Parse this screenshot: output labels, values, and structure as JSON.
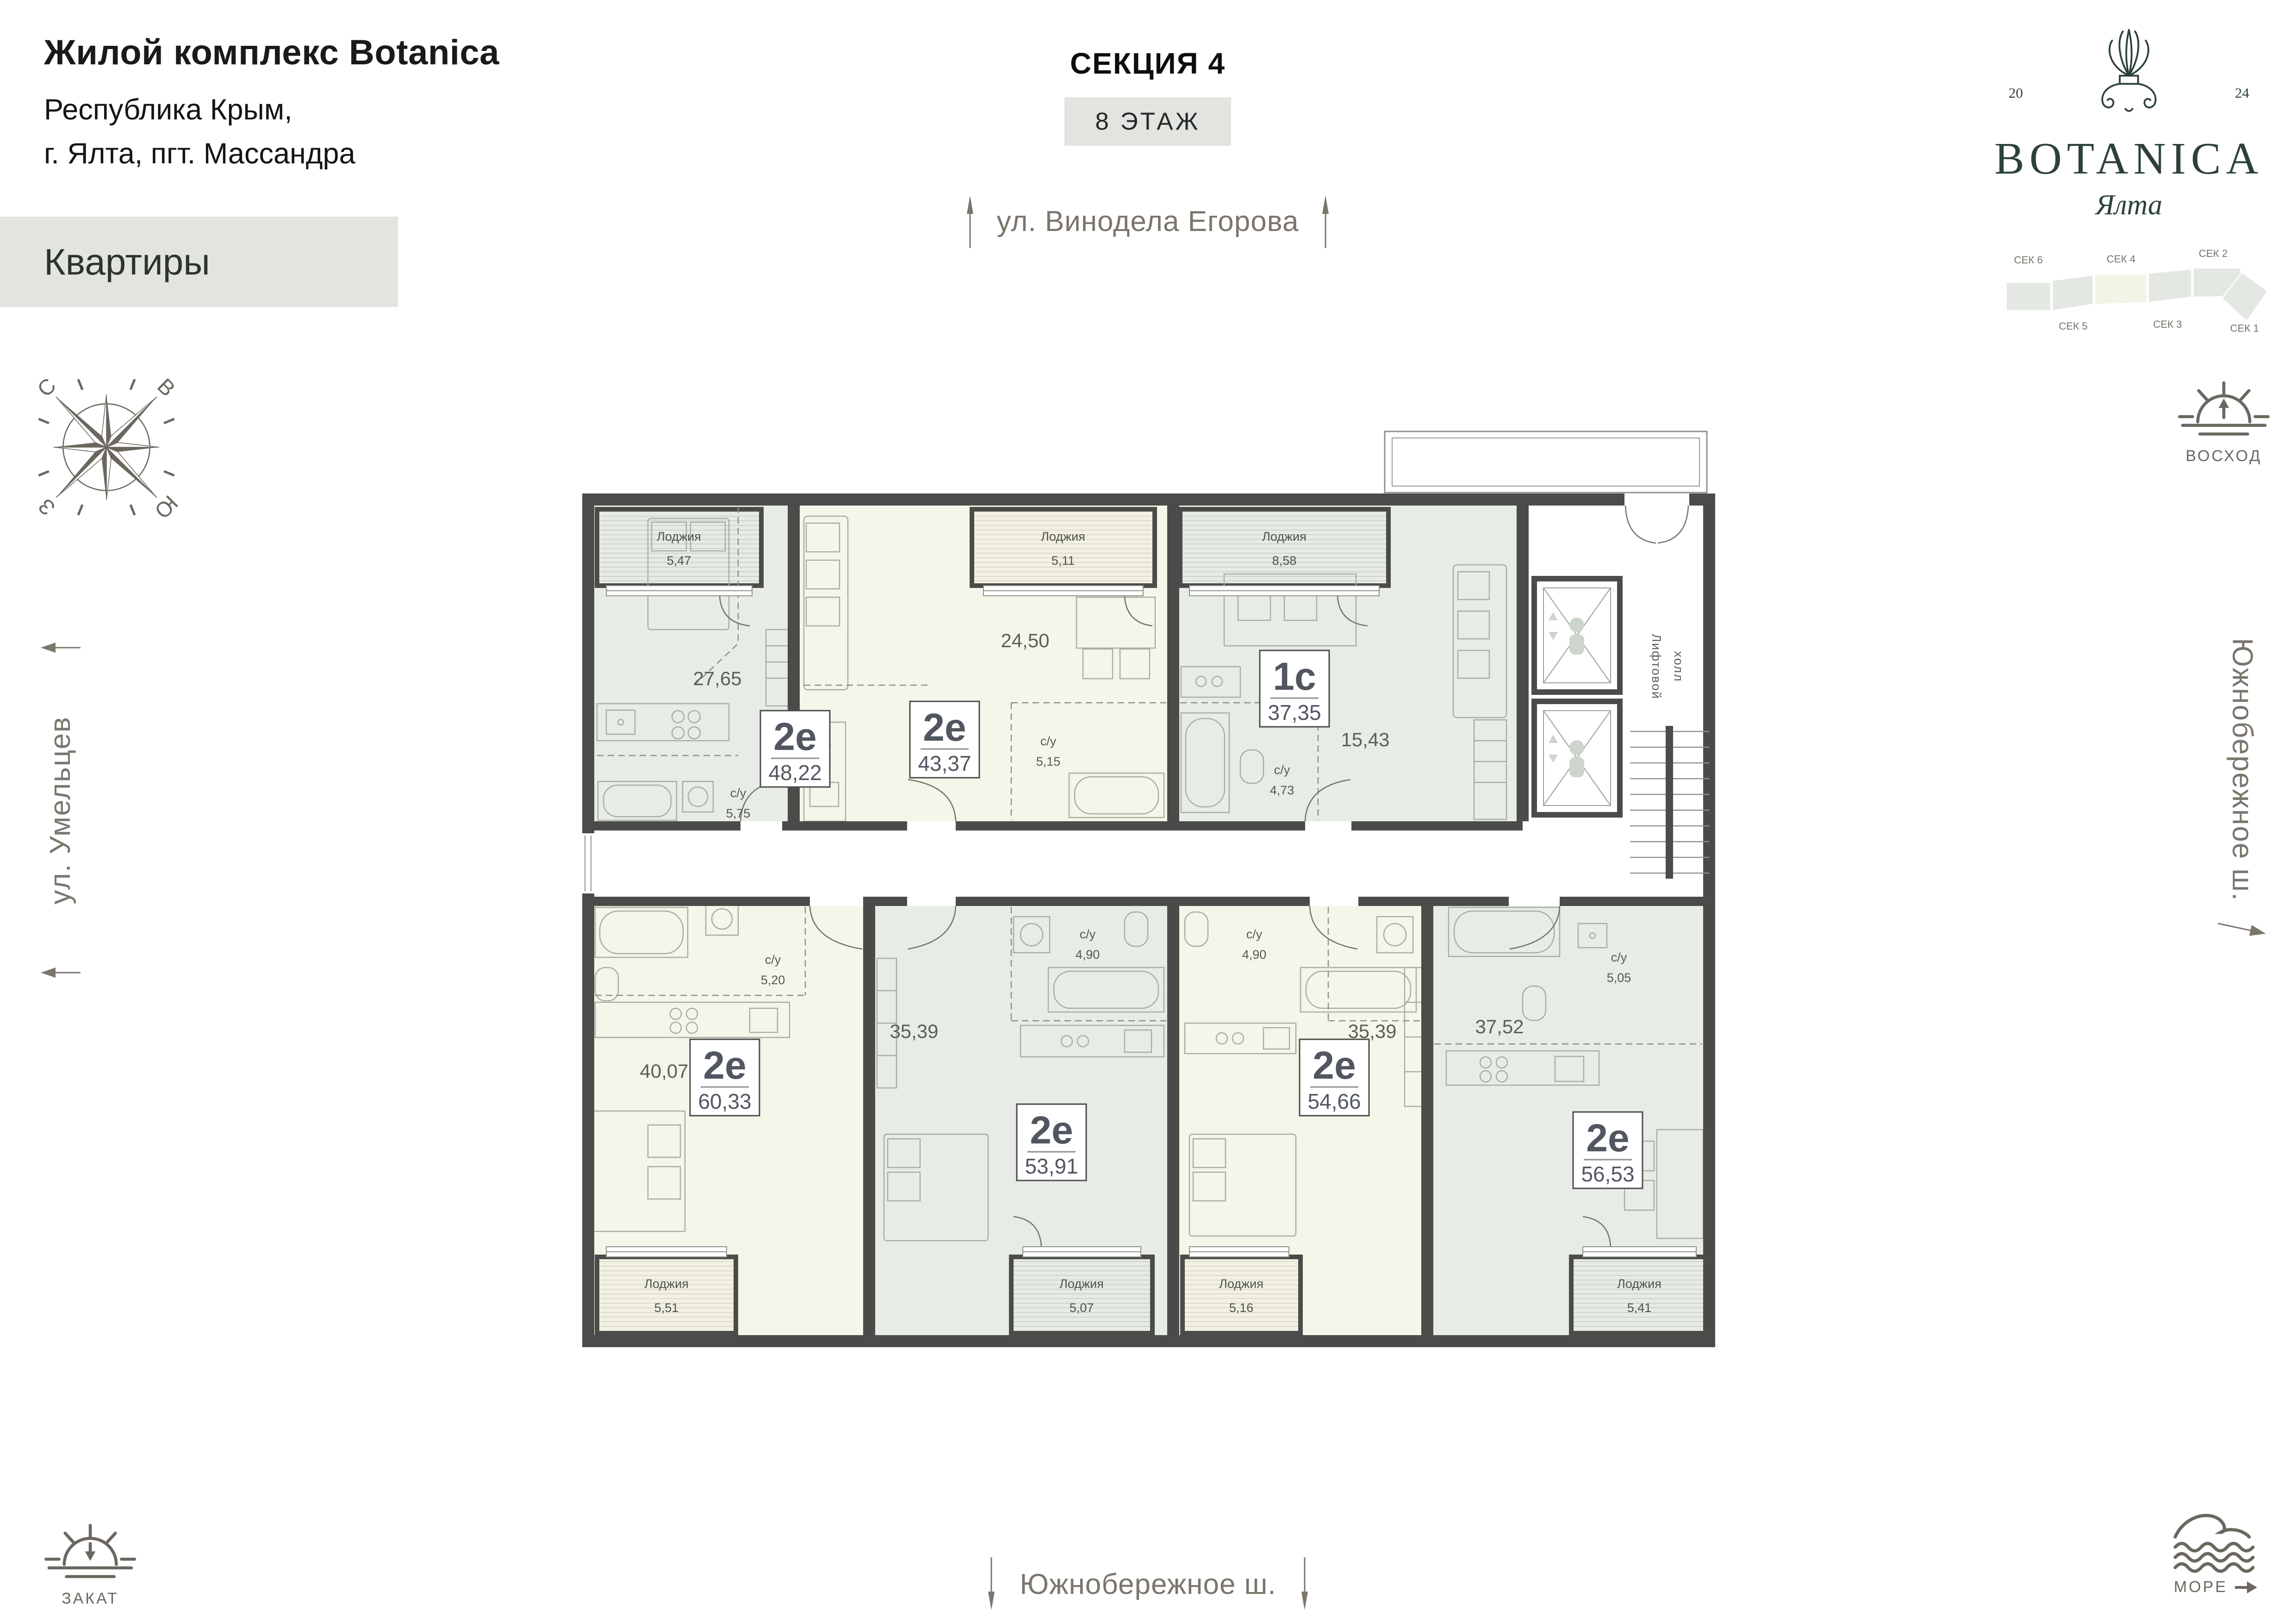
{
  "header": {
    "project_title": "Жилой комплекс Botanica",
    "address_line1": "Республика Крым,",
    "address_line2": "г. Ялта, пгт. Массандра",
    "page_label": "Квартиры",
    "section_title": "СЕКЦИЯ 4",
    "floor_label": "8 ЭТАЖ"
  },
  "logo": {
    "year_left": "20",
    "year_right": "24",
    "brand": "BOTANICA",
    "city": "Ялта"
  },
  "section_map": {
    "labels": [
      "СЕК 6",
      "СЕК 4",
      "СЕК 2",
      "СЕК 5",
      "СЕК 3",
      "СЕК 1"
    ],
    "highlighted": "СЕК 4"
  },
  "compass": {
    "n": "С",
    "e": "В",
    "w": "З",
    "s": "Ю"
  },
  "streets": {
    "top": "ул. Винодела Егорова",
    "left": "ул. Умельцев",
    "right": "Южнобережное ш.",
    "bottom": "Южнобережное ш."
  },
  "legend": {
    "sunrise": "ВОСХОД",
    "sunset": "ЗАКАТ",
    "sea": "МОРЕ"
  },
  "plan": {
    "lift_hall_line1": "Лифтовой",
    "lift_hall_line2": "холл",
    "loggia_word": "Лоджия",
    "wc_word": "с/у",
    "apartments": [
      {
        "type": "2е",
        "area": "48,22",
        "room": "27,65",
        "wc": "5,75",
        "loggia": "5,47"
      },
      {
        "type": "2е",
        "area": "43,37",
        "room": "24,50",
        "wc": "5,15",
        "loggia": "5,11"
      },
      {
        "type": "1с",
        "area": "37,35",
        "room": "15,43",
        "wc": "4,73",
        "loggia": "8,58"
      },
      {
        "type": "2е",
        "area": "60,33",
        "room": "40,07",
        "wc": "5,20",
        "loggia": "5,51"
      },
      {
        "type": "2е",
        "area": "53,91",
        "room": "35,39",
        "wc": "4,90",
        "loggia": "5,07"
      },
      {
        "type": "2е",
        "area": "54,66",
        "room": "35,39",
        "wc": "4,90",
        "loggia": "5,16"
      },
      {
        "type": "2е",
        "area": "56,53",
        "room": "37,52",
        "wc": "5,05",
        "loggia": "5,41"
      }
    ]
  },
  "colors": {
    "accent_green": "#2c4237",
    "wall": "#4b4b49",
    "sage_room": "#e8ece7",
    "cream_room": "#f6f5ea",
    "muted_text": "#7b756c",
    "box_bg": "#e2e5df"
  }
}
